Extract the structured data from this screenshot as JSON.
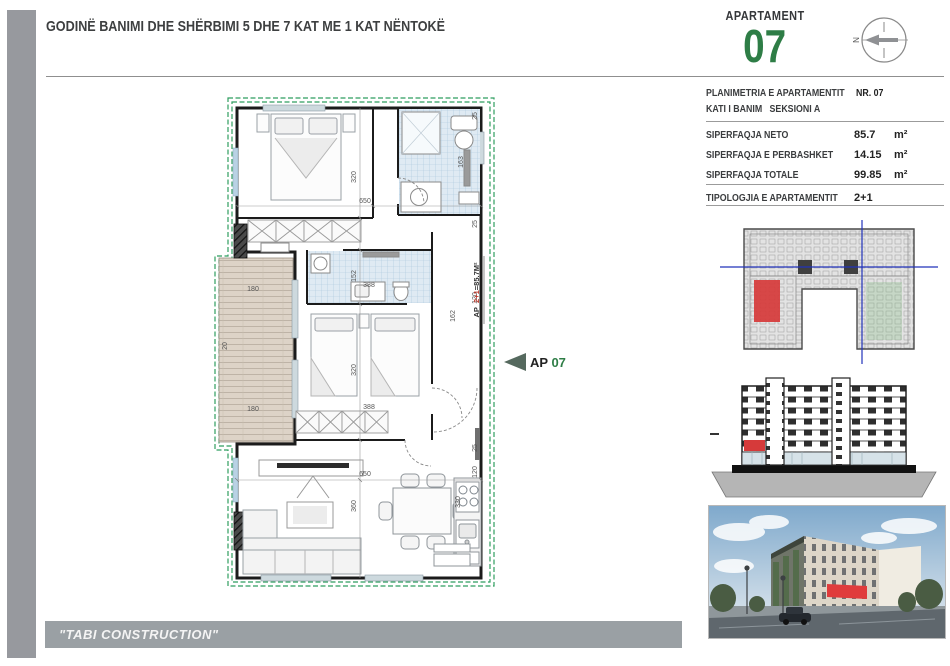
{
  "header": {
    "title": "GODINË BANIMI DHE SHËRBIMI 5 DHE 7 KAT ME 1 KAT NËNTOKË",
    "brand": "\"TABI CONSTRUCTION\""
  },
  "apartment": {
    "label": "APARTAMENT",
    "number": "07"
  },
  "compass": {
    "n": "N"
  },
  "info": {
    "planimetria": "PLANIMETRIA E APARTAMENTIT",
    "nr_label": "NR.",
    "nr_value": "07",
    "kati": "KATI I BANIM",
    "seksioni": "SEKSIONI A",
    "rows": [
      {
        "label": "SIPERFAQJA NETO",
        "value": "85.7",
        "unit": "m²"
      },
      {
        "label": "SIPERFAQJA E PERBASHKET",
        "value": "14.15",
        "unit": "m²"
      },
      {
        "label": "SIPERFAQJA TOTALE",
        "value": "99.85",
        "unit": "m²"
      }
    ],
    "tip_label": "TIPOLOGJIA E APARTAMENTIT",
    "tip_value": "2+1"
  },
  "plan": {
    "marker_ap": "AP",
    "marker_num": "07",
    "area_pre": "AP_",
    "area_mid": "2+1",
    "area_post": "=85.7M²",
    "dims": {
      "top650": "650",
      "bed1_320": "320",
      "hall152": "152",
      "bed2_320": "320",
      "liv360": "360",
      "balc180a": "180",
      "balc180b": "180",
      "hall388": "388",
      "bed2_388": "388",
      "liv650": "650",
      "kit330": "330",
      "bath163": "163",
      "r120a": "120",
      "r162": "162",
      "r120b": "120",
      "r25a": "25",
      "r25b": "25",
      "r25c": "25",
      "l20": "20"
    }
  },
  "colors": {
    "green": "#2e7d46",
    "border_green": "#2f9e5f",
    "red": "#cf3a32",
    "gray": "#97999e"
  }
}
